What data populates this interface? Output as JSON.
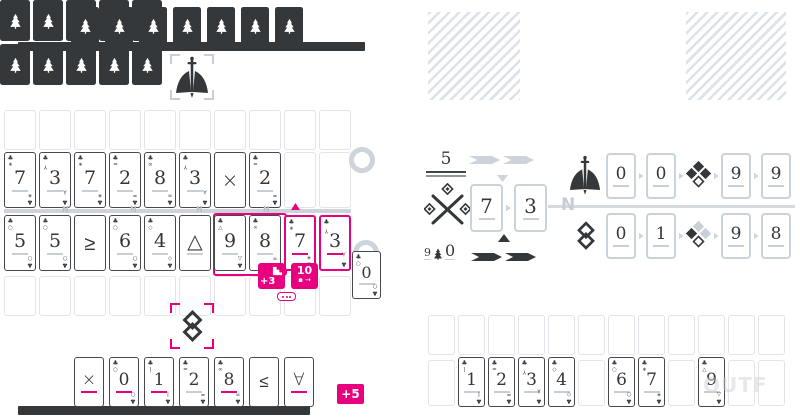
{
  "colors": {
    "dark": "#34383b",
    "accent": "#e7017f",
    "muted": "#ccd3da",
    "slot_border": "#e1e5ea"
  },
  "icons": {
    "card_back": "tree-icon",
    "faction_top": "sword-icon",
    "faction_bottom": "linked-diamonds-icon",
    "score_flower": "clover-icon",
    "bonus_steps": "stairs-icon",
    "ornament": "crossed-diamonds-icon",
    "corner_suit": "♣"
  },
  "glyph_map": {
    "0": "○",
    "1": "|",
    "2": "=",
    "3": "Y",
    "4": "◇",
    "5": "○",
    "6": "○",
    "7": "∗",
    "8": "∞",
    "9": "△"
  },
  "opponent": {
    "hand_count": 7
  },
  "reserve": {
    "backs_count": 10
  },
  "board_left": {
    "top_slots": 10,
    "row1": [
      {
        "r": "7"
      },
      {
        "r": "3"
      },
      {
        "r": "7"
      },
      {
        "r": "2"
      },
      {
        "r": "8"
      },
      {
        "r": "3"
      },
      {
        "r": "×",
        "op": true,
        "ul": "none"
      },
      {
        "r": "2"
      },
      null,
      null
    ],
    "divider_marks": [
      "N",
      "N",
      "N",
      "N"
    ],
    "row2": [
      {
        "r": "5"
      },
      {
        "r": "5"
      },
      {
        "r": "≥",
        "op": true,
        "ul": "none"
      },
      {
        "r": "6"
      },
      {
        "r": "4"
      },
      {
        "r": "△",
        "op": true
      },
      {
        "r": "9"
      },
      {
        "r": "8"
      },
      {
        "r": "7",
        "ul": "accent",
        "hl": true
      },
      {
        "r": "3",
        "ul": "accent",
        "hl": true
      }
    ],
    "bottom_slots": 10
  },
  "badges": {
    "steps_label": "+3",
    "ten_value": "10",
    "ten_icon_left": "▪",
    "ten_icon_right": "→",
    "plus_five": "+5"
  },
  "hand": [
    {
      "r": "×",
      "op": true,
      "ul": "accent"
    },
    {
      "r": "0",
      "ul": "accent"
    },
    {
      "r": "1",
      "ul": "accent"
    },
    {
      "r": "2"
    },
    {
      "r": "8",
      "ul": "accent"
    },
    {
      "r": "≤",
      "op": true,
      "ul": "none"
    },
    {
      "r": "∀",
      "op": true,
      "ul": "accent"
    }
  ],
  "zero_card": {
    "r": "0"
  },
  "score_panel": {
    "target_value": "5",
    "mult_left": "9",
    "mult_right": "0",
    "play_cards": [
      "7",
      "3"
    ],
    "nav_letter": "N",
    "rows": [
      {
        "left": [
          "0",
          "0"
        ],
        "clover": "dark",
        "right": [
          "9",
          "9"
        ]
      },
      {
        "left": [
          "0",
          "1"
        ],
        "clover": "mixed",
        "right": [
          "9",
          "8"
        ]
      }
    ]
  },
  "tableau": {
    "top_slots": 12,
    "cards": [
      null,
      {
        "r": "1"
      },
      {
        "r": "2"
      },
      {
        "r": "3"
      },
      {
        "r": "4"
      },
      null,
      {
        "r": "6"
      },
      {
        "r": "7"
      },
      null,
      {
        "r": "9"
      },
      null,
      null
    ]
  },
  "watermark": "OUTF"
}
